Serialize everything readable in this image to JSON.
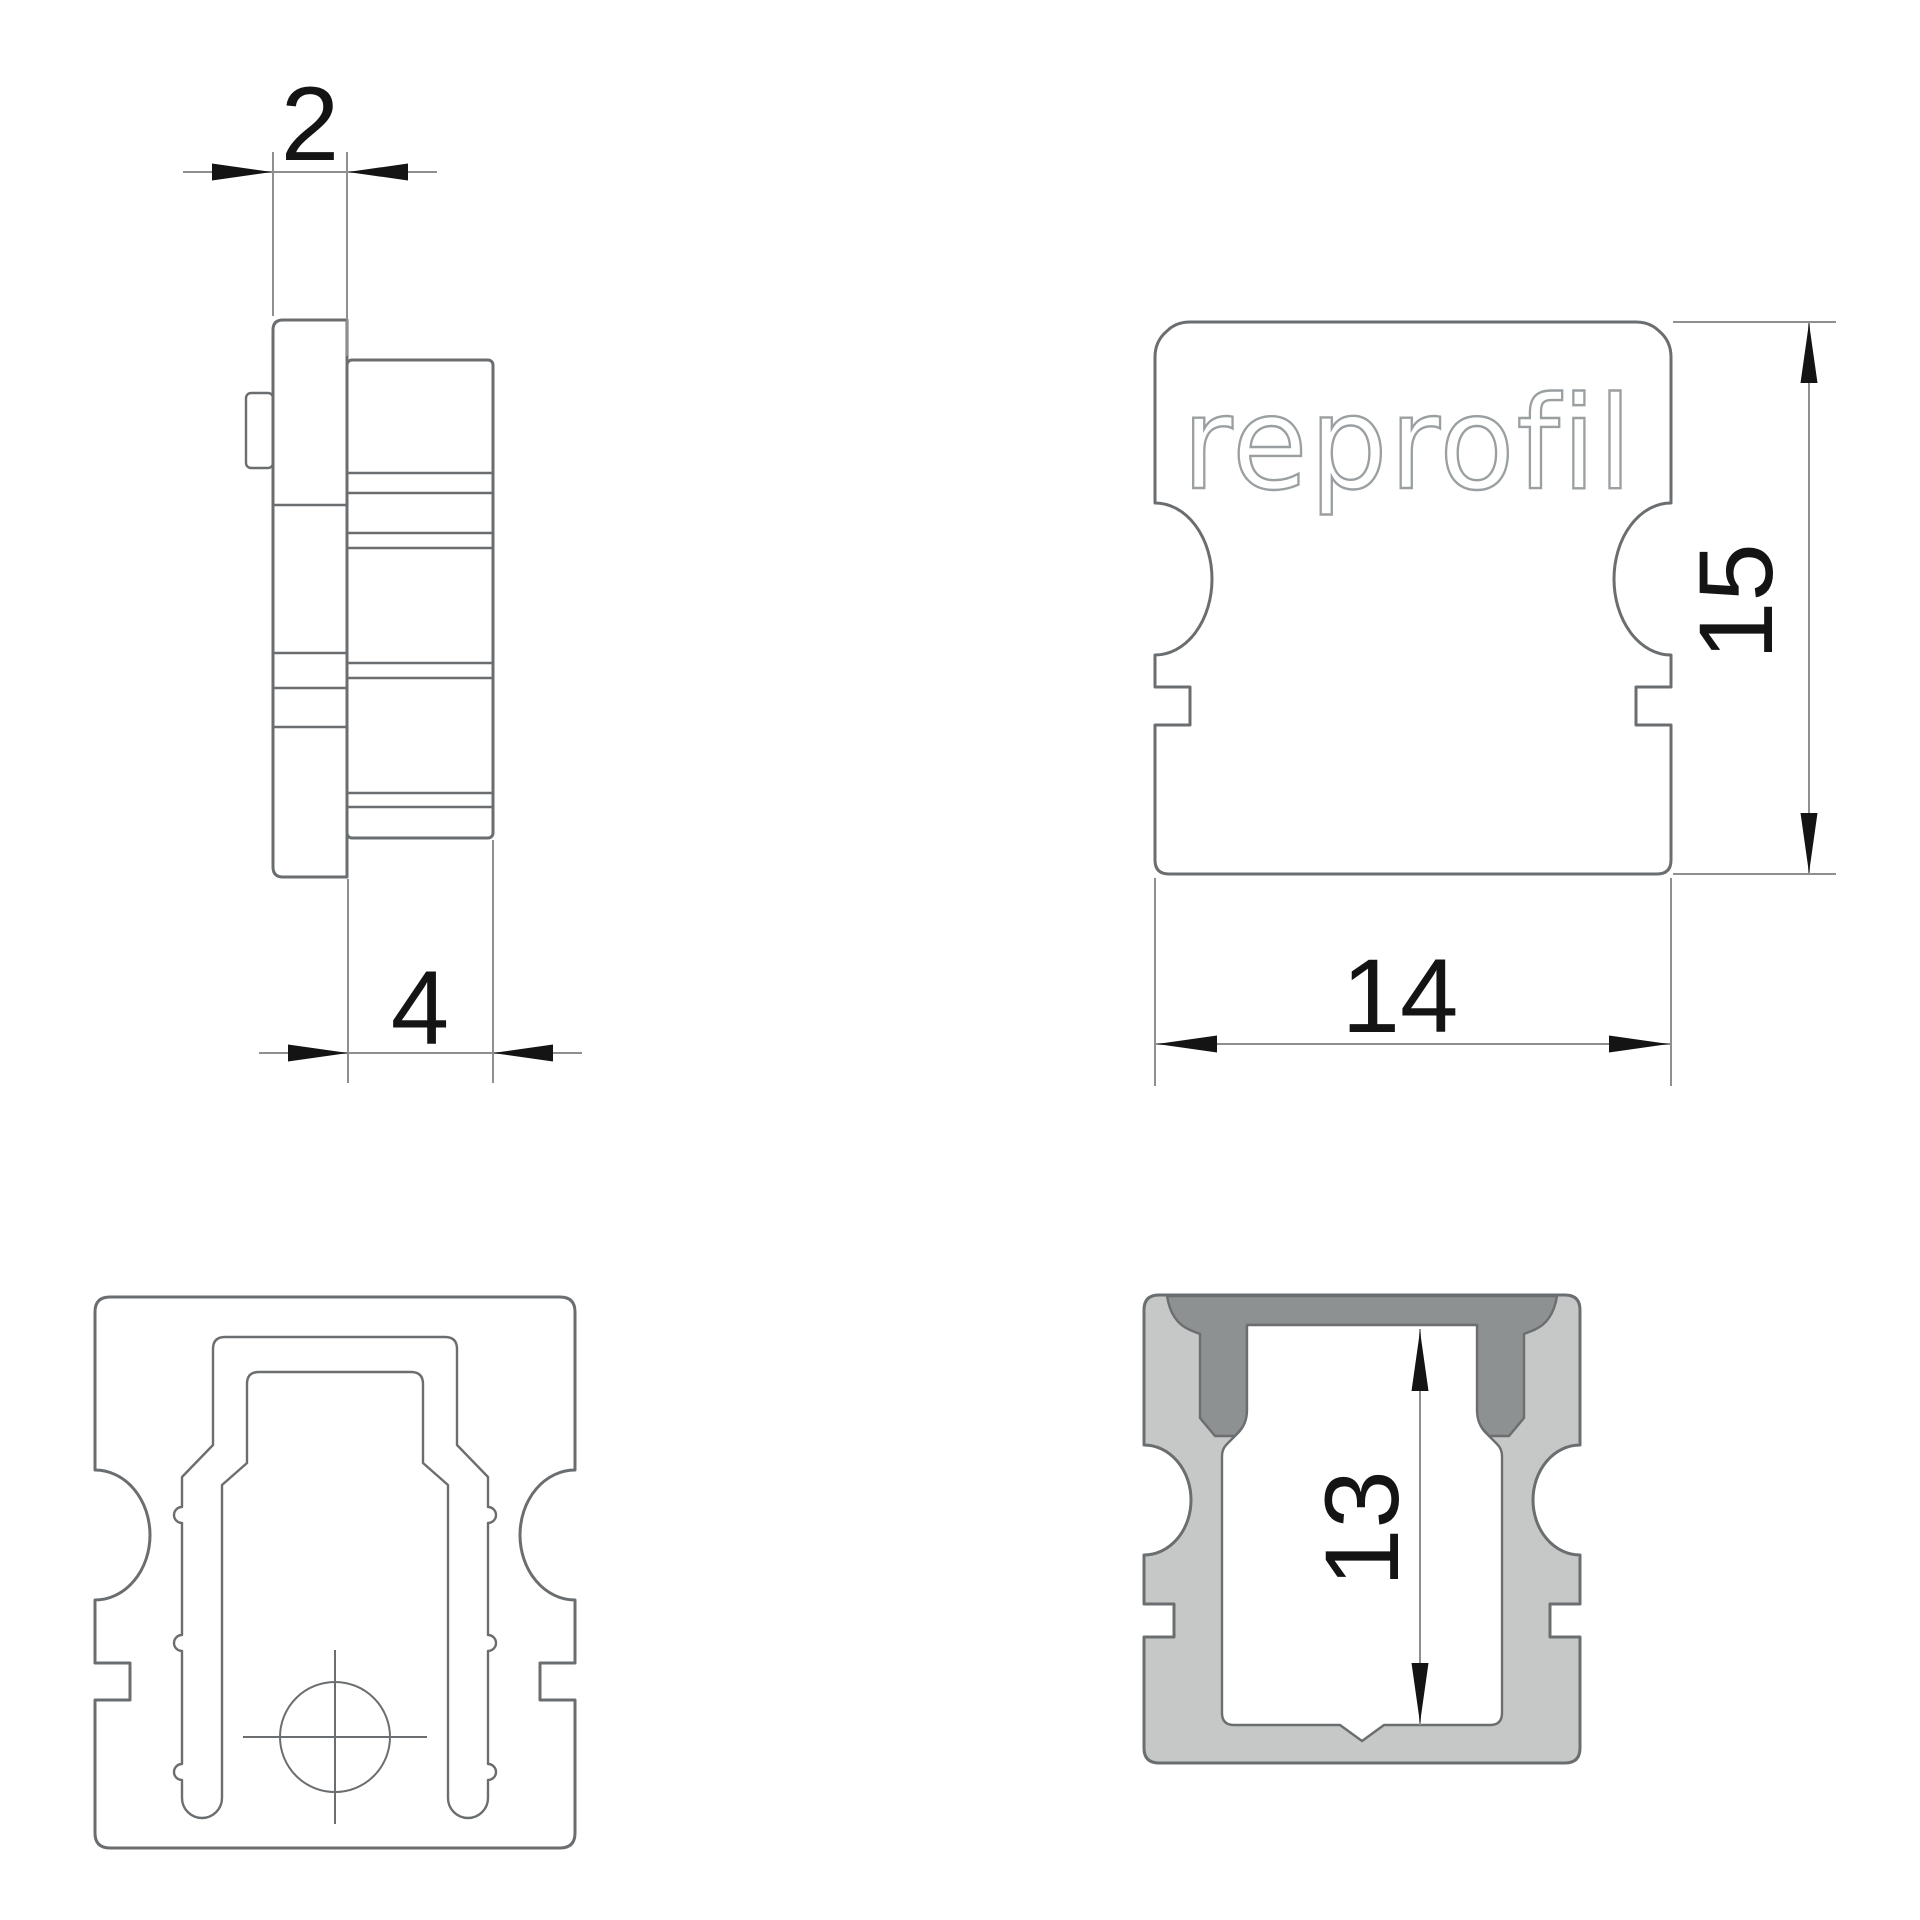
{
  "drawing": {
    "logo_text": "reprofil",
    "dimensions": {
      "plate_thickness": "2",
      "insert_depth": "4",
      "cap_width": "14",
      "cap_height": "15",
      "inner_height": "13"
    },
    "colors": {
      "background": "#ffffff",
      "geometry_line": "#6a6e70",
      "dimension_line": "#8f8f8f",
      "dimension_text": "#141414",
      "fill_light": "#c6c8c7",
      "fill_dark": "#8d9192",
      "logo_outline": "#9aa0a2"
    }
  }
}
